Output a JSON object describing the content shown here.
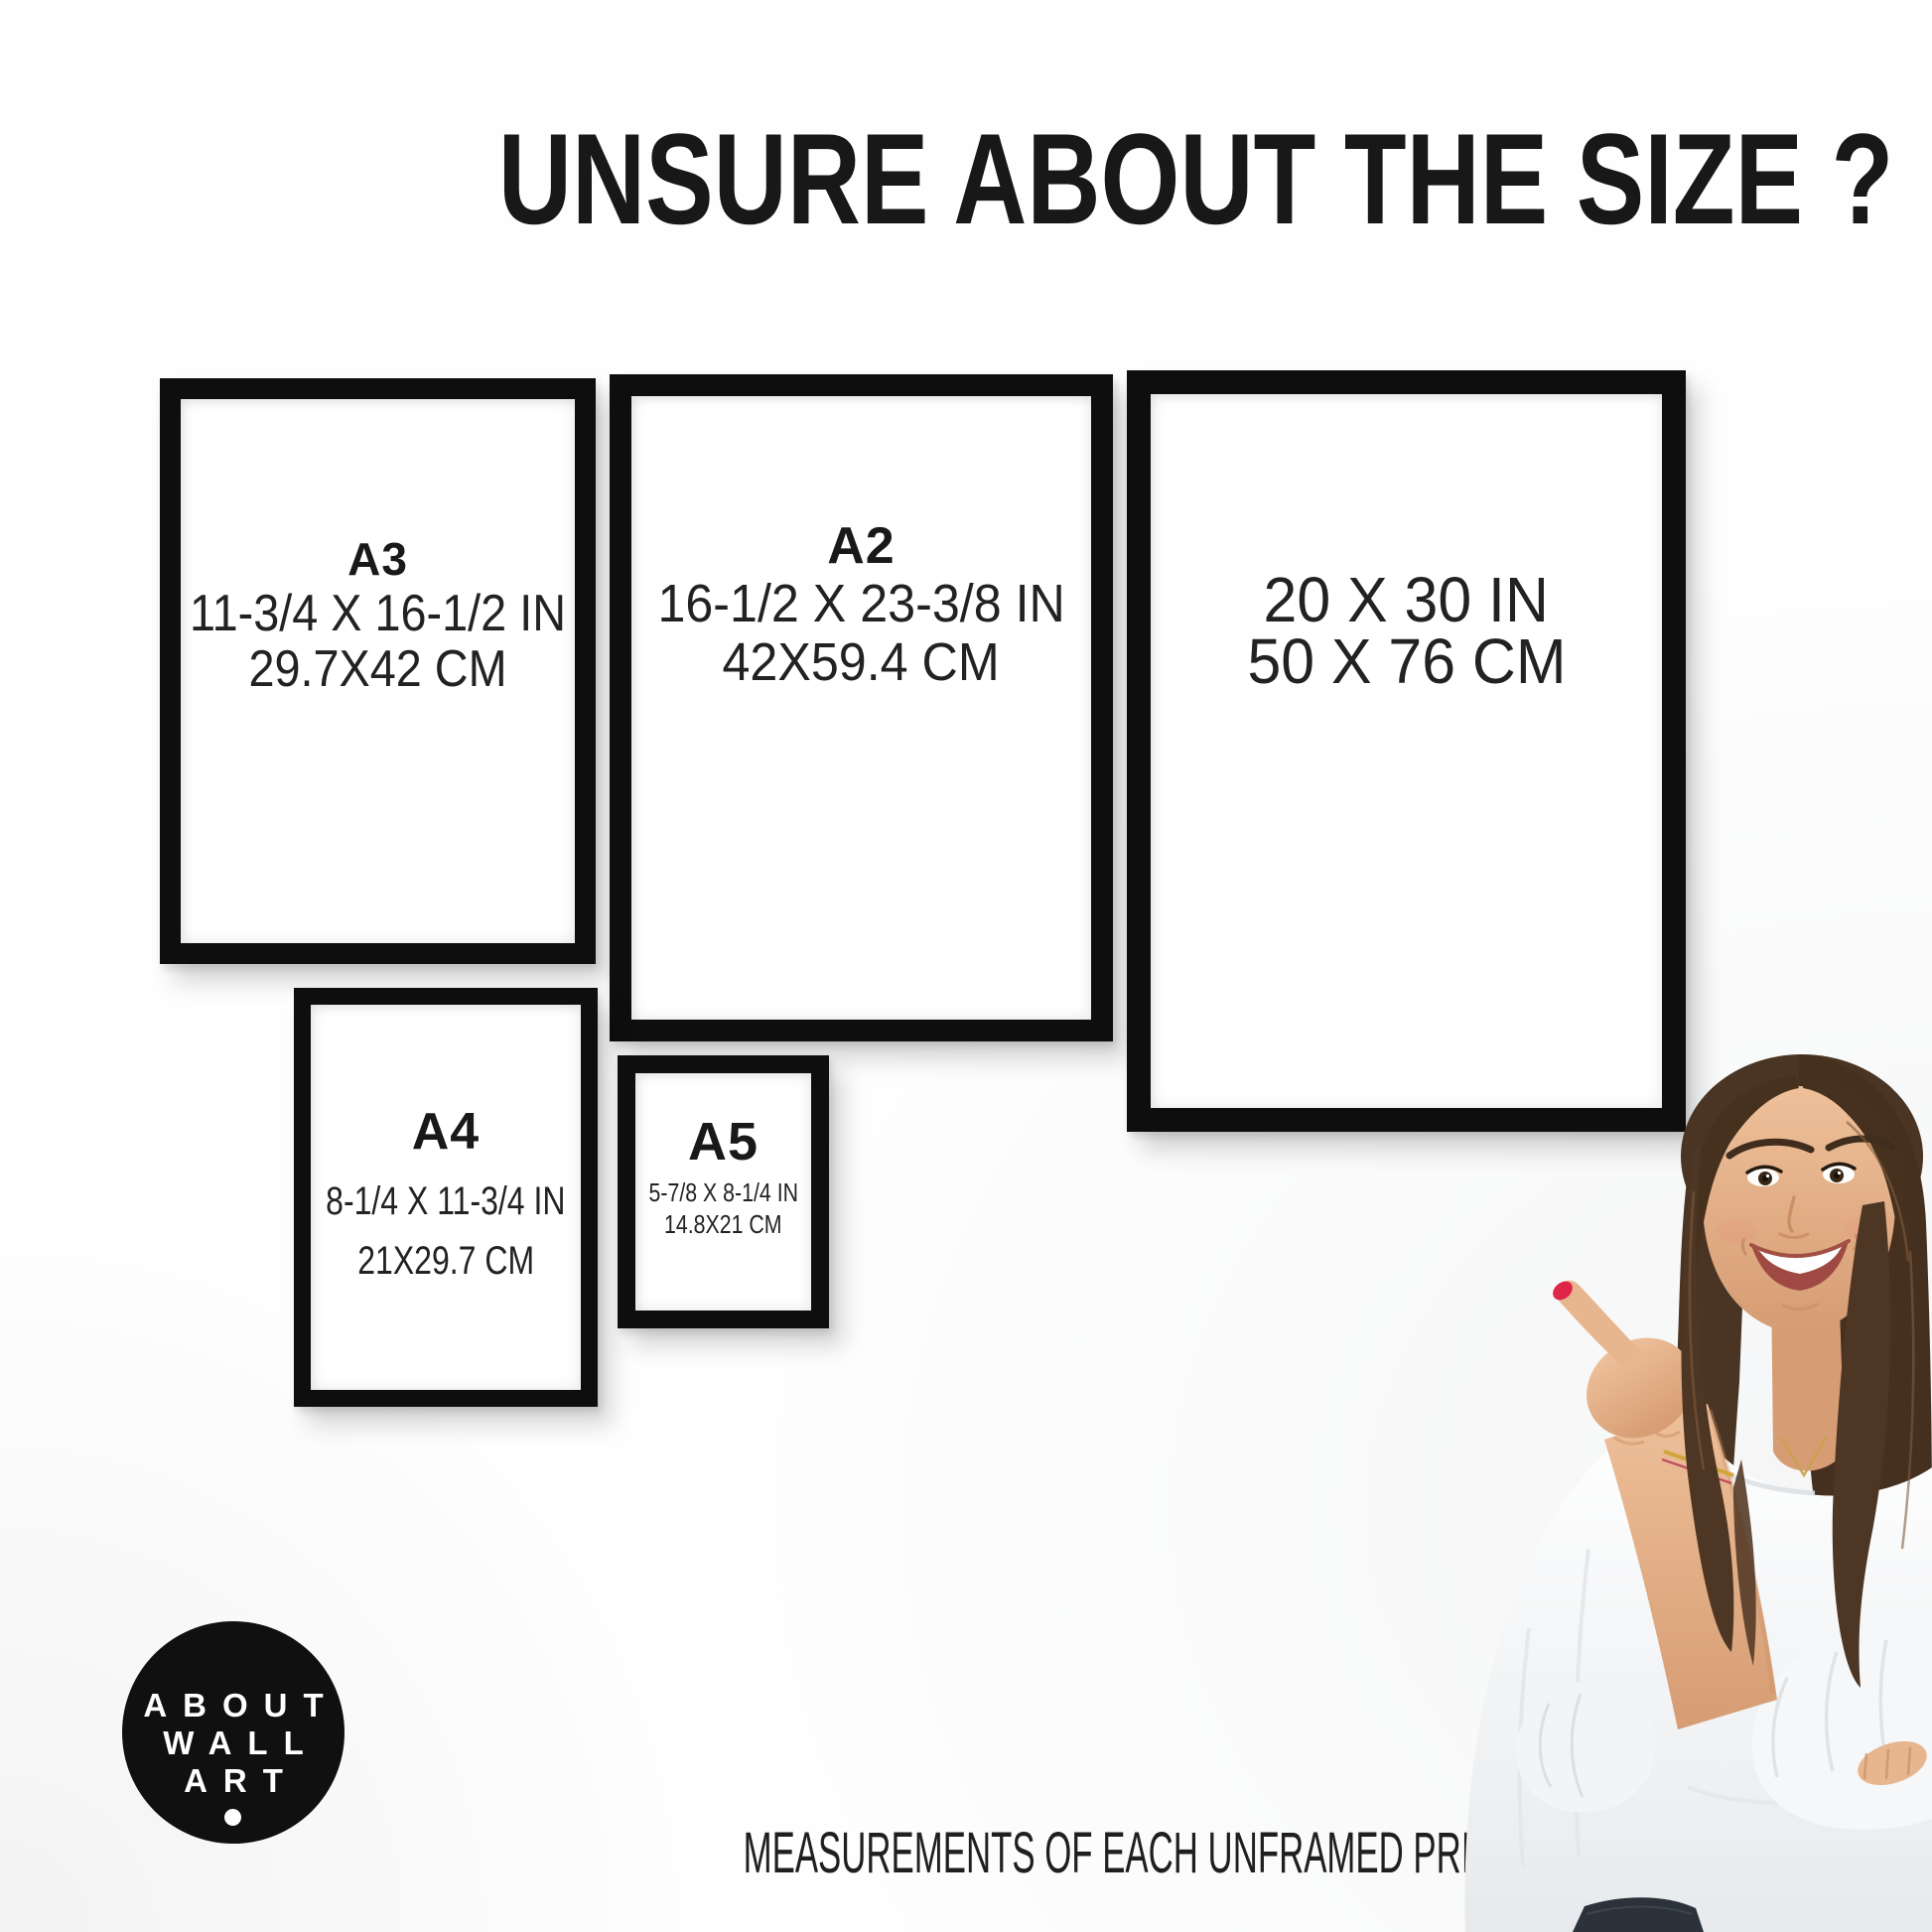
{
  "title": {
    "text": "UNSURE ABOUT THE SIZE ?"
  },
  "frames": {
    "a3": {
      "label": "A3",
      "inches": "11-3/4 X 16-1/2 IN",
      "cm": "29.7X42 CM"
    },
    "a2": {
      "label": "A2",
      "inches": "16-1/2 X 23-3/8 IN",
      "cm": "42X59.4 CM"
    },
    "poster": {
      "inches": "20 X 30 IN",
      "cm": "50 X 76 CM"
    },
    "a4": {
      "label": "A4",
      "inches": "8-1/4 X 11-3/4 IN",
      "cm": "21X29.7 CM"
    },
    "a5": {
      "label": "A5",
      "inches": "5-7/8 X 8-1/4 IN",
      "cm": "14.8X21 CM"
    }
  },
  "logo": {
    "line1": "ABOUT",
    "line2": "WALL",
    "line3": "ART"
  },
  "footer": {
    "caption": "MEASUREMENTS OF EACH UNFRAMED PRINT/POSTER"
  },
  "colors": {
    "frame_black": "#0e0e0e",
    "text": "#1c1c1c",
    "logo_background": "#101010",
    "nail_red": "#e02648",
    "hair_brown": "#4a3423",
    "blouse_white": "#f5f7f8",
    "skin": "#e7b68e"
  }
}
